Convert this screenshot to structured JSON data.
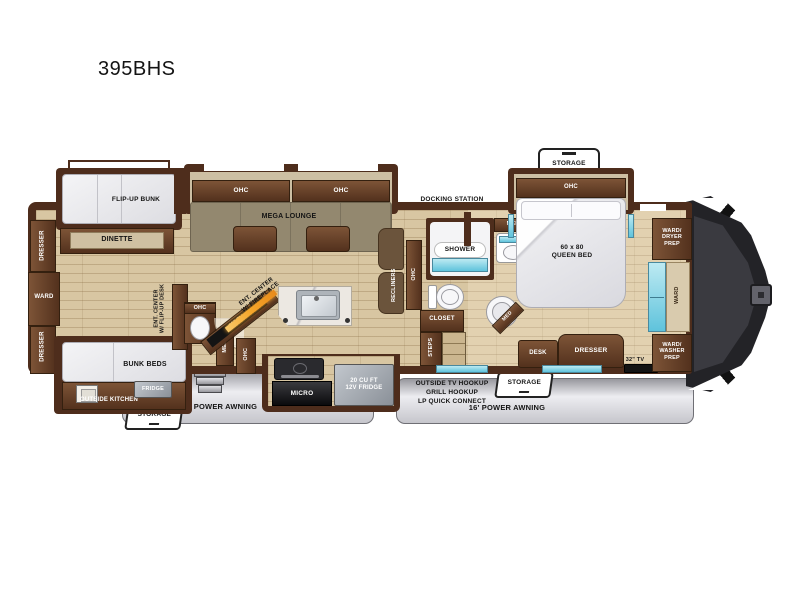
{
  "title": "395BHS",
  "colors": {
    "wall_brown": "#4e2d1c",
    "cabinet_wood": "#6a4530",
    "floor_tan": "#d8c6a2",
    "window_cyan": "#7fd0e4",
    "fireplace_orange": "#f5a62a",
    "awning_gray": "#d9d9dd",
    "mattress_gray": "#e8e8ec",
    "label_black": "#141414"
  },
  "labels": {
    "flip_up_bunk": "FLIP-UP BUNK",
    "dinette": "DINETTE",
    "dresser_rear_top": "DRESSER",
    "ward_rear": "WARD",
    "dresser_rear_bottom": "DRESSER",
    "bunk_beds": "BUNK BEDS",
    "outside_kitchen": "OUTSIDE KITCHEN",
    "fridge_outside": "FRIDGE",
    "storage_rear": "STORAGE",
    "awning_13": "13' POWER AWNING",
    "ohc_lounge_left": "OHC",
    "ohc_lounge_right": "OHC",
    "mega_lounge": "MEGA LOUNGE",
    "ent_center_desk": "ENT. CENTER\nW/ FLIP-UP DESK",
    "ohc_half_bath": "OHC",
    "med_half_bath": "MED",
    "ohc_half_bath_2": "OHC",
    "ent_center_fireplace": "ENT. CENTER\nW/ FIREPLACE",
    "tv_50": "50\" TV",
    "micro": "MICRO",
    "fridge_12v": "20 CU FT\n12V FRIDGE",
    "recliners": "RECLINERS",
    "ohc_recliners": "OHC",
    "docking_station": "DOCKING STATION\nOUTSIDE SHOWER",
    "shower": "SHOWER",
    "med_bath": "MED",
    "closet": "CLOSET",
    "steps": "STEPS",
    "storage_bed": "STORAGE",
    "ohc_bed": "OHC",
    "queen_bed": "60 x 80\nQUEEN BED",
    "med_bedroom": "MED",
    "desk": "DESK",
    "dresser_bedroom": "DRESSER",
    "tv_32": "32\" TV",
    "ward_dryer_prep": "WARD/\nDRYER\nPREP",
    "ward_front": "WARD",
    "ward_washer_prep": "WARD/\nWASHER\nPREP",
    "outside_tv_hookup": "OUTSIDE TV HOOKUP",
    "grill_hookup": "GRILL HOOKUP",
    "lp_quick_connect": "LP QUICK CONNECT",
    "storage_front": "STORAGE",
    "awning_16": "16' POWER AWNING"
  }
}
